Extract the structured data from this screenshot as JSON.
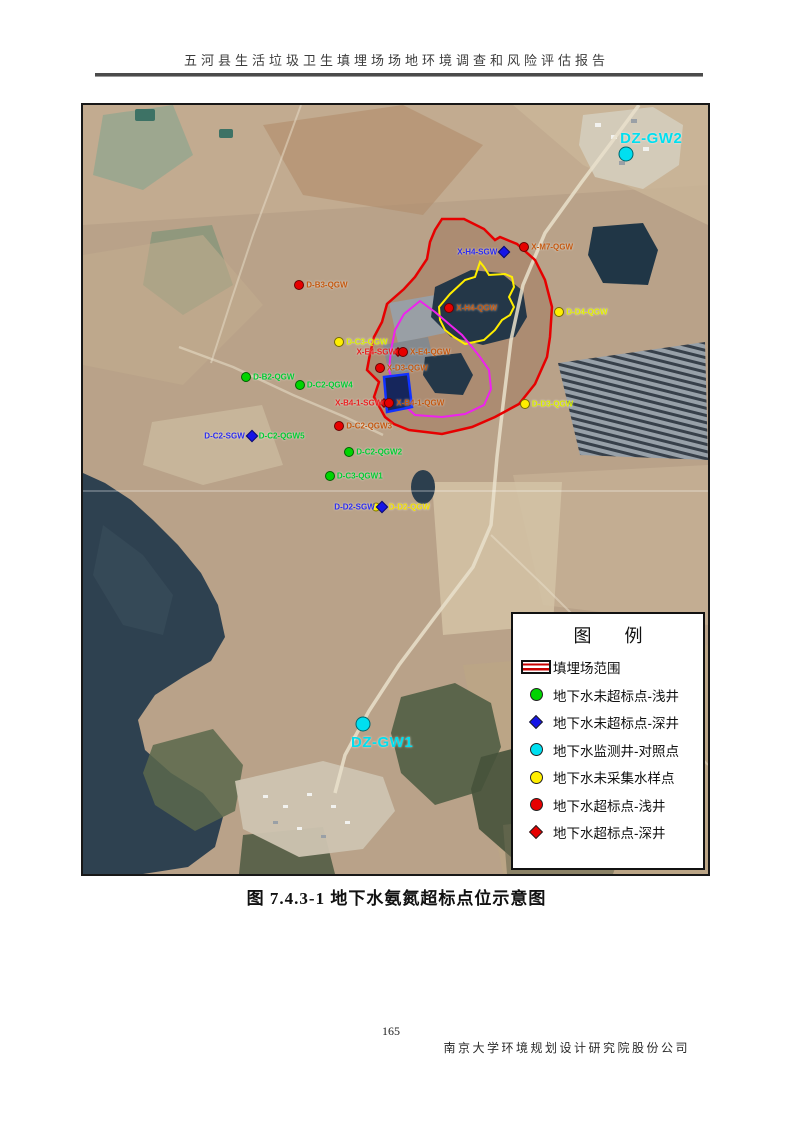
{
  "page": {
    "header_title": "五河县生活垃圾卫生填埋场场地环境调查和风险评估报告",
    "caption": "图 7.4.3-1   地下水氨氮超标点位示意图",
    "page_number": "165",
    "footer_company": "南京大学环境规划设计研究院股份公司"
  },
  "legend": {
    "title": "图 例",
    "items": [
      {
        "symbol": "landfill",
        "color": "#c80000",
        "label": "填埋场范围"
      },
      {
        "symbol": "circle",
        "color": "#00d400",
        "label": "地下水未超标点-浅井"
      },
      {
        "symbol": "diamond",
        "color": "#1515e6",
        "label": "地下水未超标点-深井"
      },
      {
        "symbol": "circle",
        "color": "#00dff0",
        "label": "地下水监测井-对照点"
      },
      {
        "symbol": "circle",
        "color": "#ffee00",
        "label": "地下水未采集水样点"
      },
      {
        "symbol": "circle",
        "color": "#e60000",
        "label": "地下水超标点-浅井"
      },
      {
        "symbol": "diamond",
        "color": "#e60000",
        "label": "地下水超标点-深井"
      }
    ]
  },
  "map": {
    "boundary_colors": {
      "landfill_outline": "#e60000",
      "pond_outline": "#ffee00",
      "inner_outline": "#ee22ee",
      "cell_outline": "#1133ff"
    },
    "points": [
      {
        "name": "DZ-GW2",
        "marker": "circle",
        "color": "#00dff0",
        "size": 15,
        "x": 86.9,
        "y": 6.4,
        "label_top": {
          "text": "DZ-GW2",
          "color": "#00dff0"
        }
      },
      {
        "name": "X-H4-SGW",
        "marker": "diamond",
        "color": "#1515e6",
        "size": 9,
        "x": 67.4,
        "y": 19.1,
        "label_left": {
          "text": "X-H4-SGW",
          "color": "#2a2af0"
        }
      },
      {
        "name": "X-M7-QGW",
        "marker": "circle",
        "color": "#e60000",
        "size": 10,
        "x": 70.6,
        "y": 18.5,
        "label_right": {
          "text": "X-M7-QGW",
          "color": "#c45911"
        }
      },
      {
        "name": "D-B3-QGW",
        "marker": "circle",
        "color": "#e60000",
        "size": 10,
        "x": 34.6,
        "y": 23.4,
        "label_right": {
          "text": "D-B3-QGW",
          "color": "#c45911"
        }
      },
      {
        "name": "X-H4-QGW",
        "marker": "circle",
        "color": "#e60000",
        "size": 10,
        "x": 58.6,
        "y": 26.4,
        "label_right": {
          "text": "X-H4-QGW",
          "color": "#c45911"
        }
      },
      {
        "name": "D-D4-QGW",
        "marker": "circle",
        "color": "#ffee00",
        "size": 10,
        "x": 76.2,
        "y": 26.9,
        "label_right": {
          "text": "D-D4-QGW",
          "color": "#e0ee00"
        }
      },
      {
        "name": "D-C3-QGW",
        "marker": "circle",
        "color": "#ffee00",
        "size": 10,
        "x": 41.0,
        "y": 30.8,
        "label_right": {
          "text": "D-C3-QGW",
          "color": "#d8ee00"
        }
      },
      {
        "name": "X-E4",
        "marker": "circle",
        "color": "#e60000",
        "size": 10,
        "x": 51.2,
        "y": 32.1,
        "marker2": "diamond-red",
        "label_left": {
          "text": "X-E4-SGW",
          "color": "#e82222"
        },
        "label_right": {
          "text": "X-E4-QGW",
          "color": "#c45911"
        }
      },
      {
        "name": "X-D3-QGW",
        "marker": "circle",
        "color": "#e60000",
        "size": 10,
        "x": 47.5,
        "y": 34.2,
        "label_right": {
          "text": "X-D3-QGW",
          "color": "#c45911"
        }
      },
      {
        "name": "D-B2-QGW",
        "marker": "circle",
        "color": "#00d400",
        "size": 10,
        "x": 26.1,
        "y": 35.4,
        "label_right": {
          "text": "D-B2-QGW",
          "color": "#00cc33"
        }
      },
      {
        "name": "D-C2-QGW4",
        "marker": "circle",
        "color": "#00d400",
        "size": 10,
        "x": 34.7,
        "y": 36.4,
        "label_right": {
          "text": "D-C2-QGW4",
          "color": "#00cc33"
        }
      },
      {
        "name": "X-B4-1",
        "marker": "circle",
        "color": "#e60000",
        "size": 10,
        "x": 49.0,
        "y": 38.8,
        "marker2": "diamond-red",
        "label_left": {
          "text": "X-B4-1-SGW",
          "color": "#e82222"
        },
        "label_right": {
          "text": "X-B4-1-QGW",
          "color": "#c45911"
        }
      },
      {
        "name": "D-D3-QGW",
        "marker": "circle",
        "color": "#ffee00",
        "size": 10,
        "x": 70.7,
        "y": 38.9,
        "label_right": {
          "text": "D-D3-QGW",
          "color": "#d8ee00"
        }
      },
      {
        "name": "D-C2-QGW3",
        "marker": "circle",
        "color": "#e60000",
        "size": 10,
        "x": 41.0,
        "y": 41.7,
        "label_right": {
          "text": "D-C2-QGW3",
          "color": "#c45911"
        }
      },
      {
        "name": "D-C2-SGW",
        "marker": "diamond",
        "color": "#1515e6",
        "size": 9,
        "x": 27.0,
        "y": 43.0,
        "label_left": {
          "text": "D-C2-SGW",
          "color": "#2a2af0"
        },
        "label_right": {
          "text": "D-C2-QGW5",
          "color": "#00cc33"
        }
      },
      {
        "name": "D-C2-QGW2",
        "marker": "circle",
        "color": "#00d400",
        "size": 10,
        "x": 42.6,
        "y": 45.1,
        "label_right": {
          "text": "D-C2-QGW2",
          "color": "#00cc33"
        }
      },
      {
        "name": "D-C3-QGW1",
        "marker": "circle",
        "color": "#00d400",
        "size": 10,
        "x": 39.5,
        "y": 48.2,
        "label_right": {
          "text": "D-C3-QGW1",
          "color": "#00cc33"
        }
      },
      {
        "name": "D-D2",
        "marker": "diamond",
        "color": "#1515e6",
        "size": 9,
        "x": 47.8,
        "y": 52.3,
        "marker2": "circle-yellow",
        "label_left": {
          "text": "D-D2-SGW",
          "color": "#2a2af0"
        },
        "label_right": {
          "text": "D-D2-QGW",
          "color": "#f0e000"
        }
      },
      {
        "name": "DZ-GW1",
        "marker": "circle",
        "color": "#00dff0",
        "size": 15,
        "x": 44.8,
        "y": 80.5,
        "label_bottom": {
          "text": "DZ-GW1",
          "color": "#00dff0"
        }
      }
    ]
  }
}
